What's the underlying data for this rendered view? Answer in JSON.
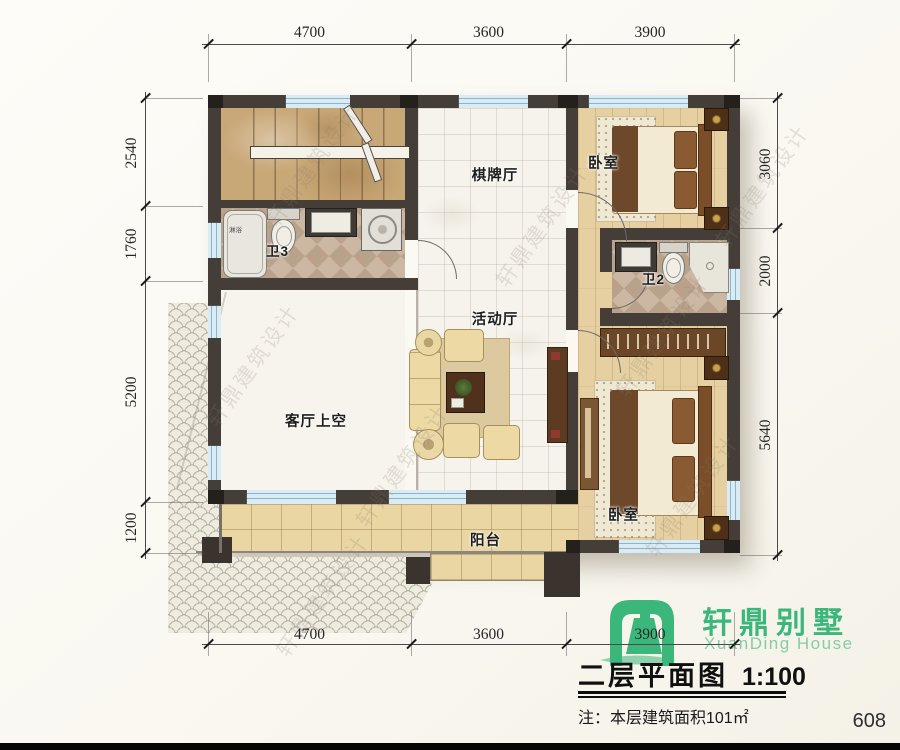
{
  "page": {
    "number": "608"
  },
  "brand": {
    "name_cn": "轩鼎别墅",
    "name_en": "XuanDing House"
  },
  "title_block": {
    "title": "二层平面图",
    "scale": "1:100",
    "note": "注：本层建筑面积101㎡"
  },
  "watermark": {
    "text": "轩鼎建筑设计"
  },
  "rooms": {
    "chess_hall": "棋牌厅",
    "bedroom_top": "卧室",
    "bath3": "卫3",
    "bath2": "卫2",
    "activity_hall": "活动厅",
    "living_void": "客厅上空",
    "balcony": "阳台",
    "bedroom_bottom": "卧室",
    "shower": "淋浴"
  },
  "dimensions": {
    "top": [
      "4700",
      "3600",
      "3900"
    ],
    "bottom": [
      "4700",
      "3600",
      "3900"
    ],
    "left": [
      "2540",
      "1760",
      "5200",
      "1200"
    ],
    "right": [
      "3060",
      "2000",
      "5640"
    ]
  },
  "colors": {
    "wall": "#453e38",
    "window_fill": "#d9ecf5",
    "brand_green": "#3cb77c",
    "brand_green_light": "#8ed2ab",
    "floor_wood": "#e6d0a2",
    "floor_tile": "#f5f3ec"
  }
}
